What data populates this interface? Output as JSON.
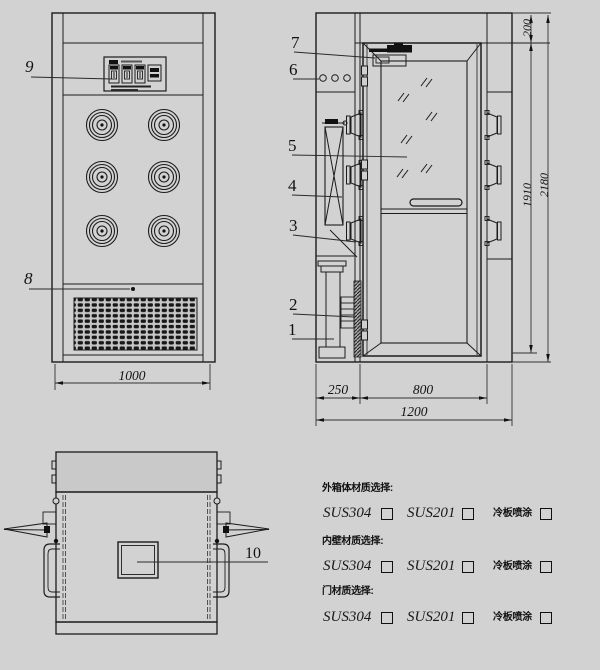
{
  "colors": {
    "background": "#d2d2d2",
    "line": "#1c1c1c",
    "dark_fill": "#111111"
  },
  "front_view": {
    "callout_control_panel": "9",
    "callout_grille": "8",
    "dim_width": "1000"
  },
  "side_view": {
    "callout_door_closer": "7",
    "callout_indicator_lights": "6",
    "callout_glass_door": "5",
    "callout_filter": "4",
    "callout_nozzle": "3",
    "callout_heater": "2",
    "callout_fan": "1",
    "dim_header_height": "200",
    "dim_door_height": "1910",
    "dim_total_height": "2180",
    "dim_plenum_depth": "250",
    "dim_door_width": "800",
    "dim_total_width": "1200"
  },
  "top_view": {
    "callout_opening": "10"
  },
  "materials": {
    "sections": [
      {
        "title": "外箱体材质选择:",
        "options": [
          "SUS304",
          "SUS201",
          "冷板喷涂"
        ]
      },
      {
        "title": "内壁材质选择:",
        "options": [
          "SUS304",
          "SUS201",
          "冷板喷涂"
        ]
      },
      {
        "title": "门材质选择:",
        "options": [
          "SUS304",
          "SUS201",
          "冷板喷涂"
        ]
      }
    ]
  }
}
